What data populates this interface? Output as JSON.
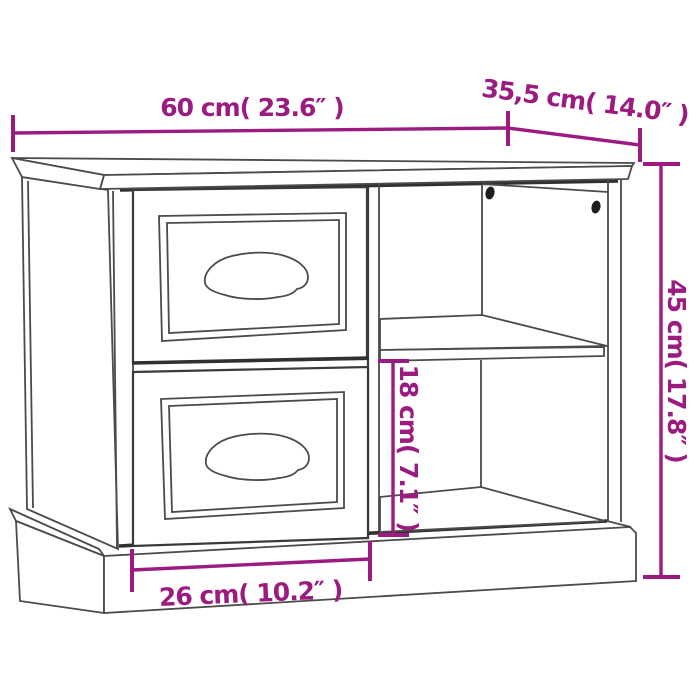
{
  "diagram": {
    "type": "product-dimension-line-drawing",
    "subject": "nightstand with two drawers and open side shelf compartment",
    "colors": {
      "dimension_annotation": "#9C1B80",
      "outline": "#4b4b4b",
      "outline_dark": "#303030",
      "screw_hole": "#1e1e1e",
      "background": "#ffffff"
    },
    "dimensions": {
      "width": "60 cm( 23.6″ )",
      "depth": "35,5 cm( 14.0″ )",
      "height": "45 cm( 17.8″ )",
      "compartment_height": "18 cm( 7.1″ )",
      "compartment_width": "26 cm( 10.2″ )"
    }
  }
}
